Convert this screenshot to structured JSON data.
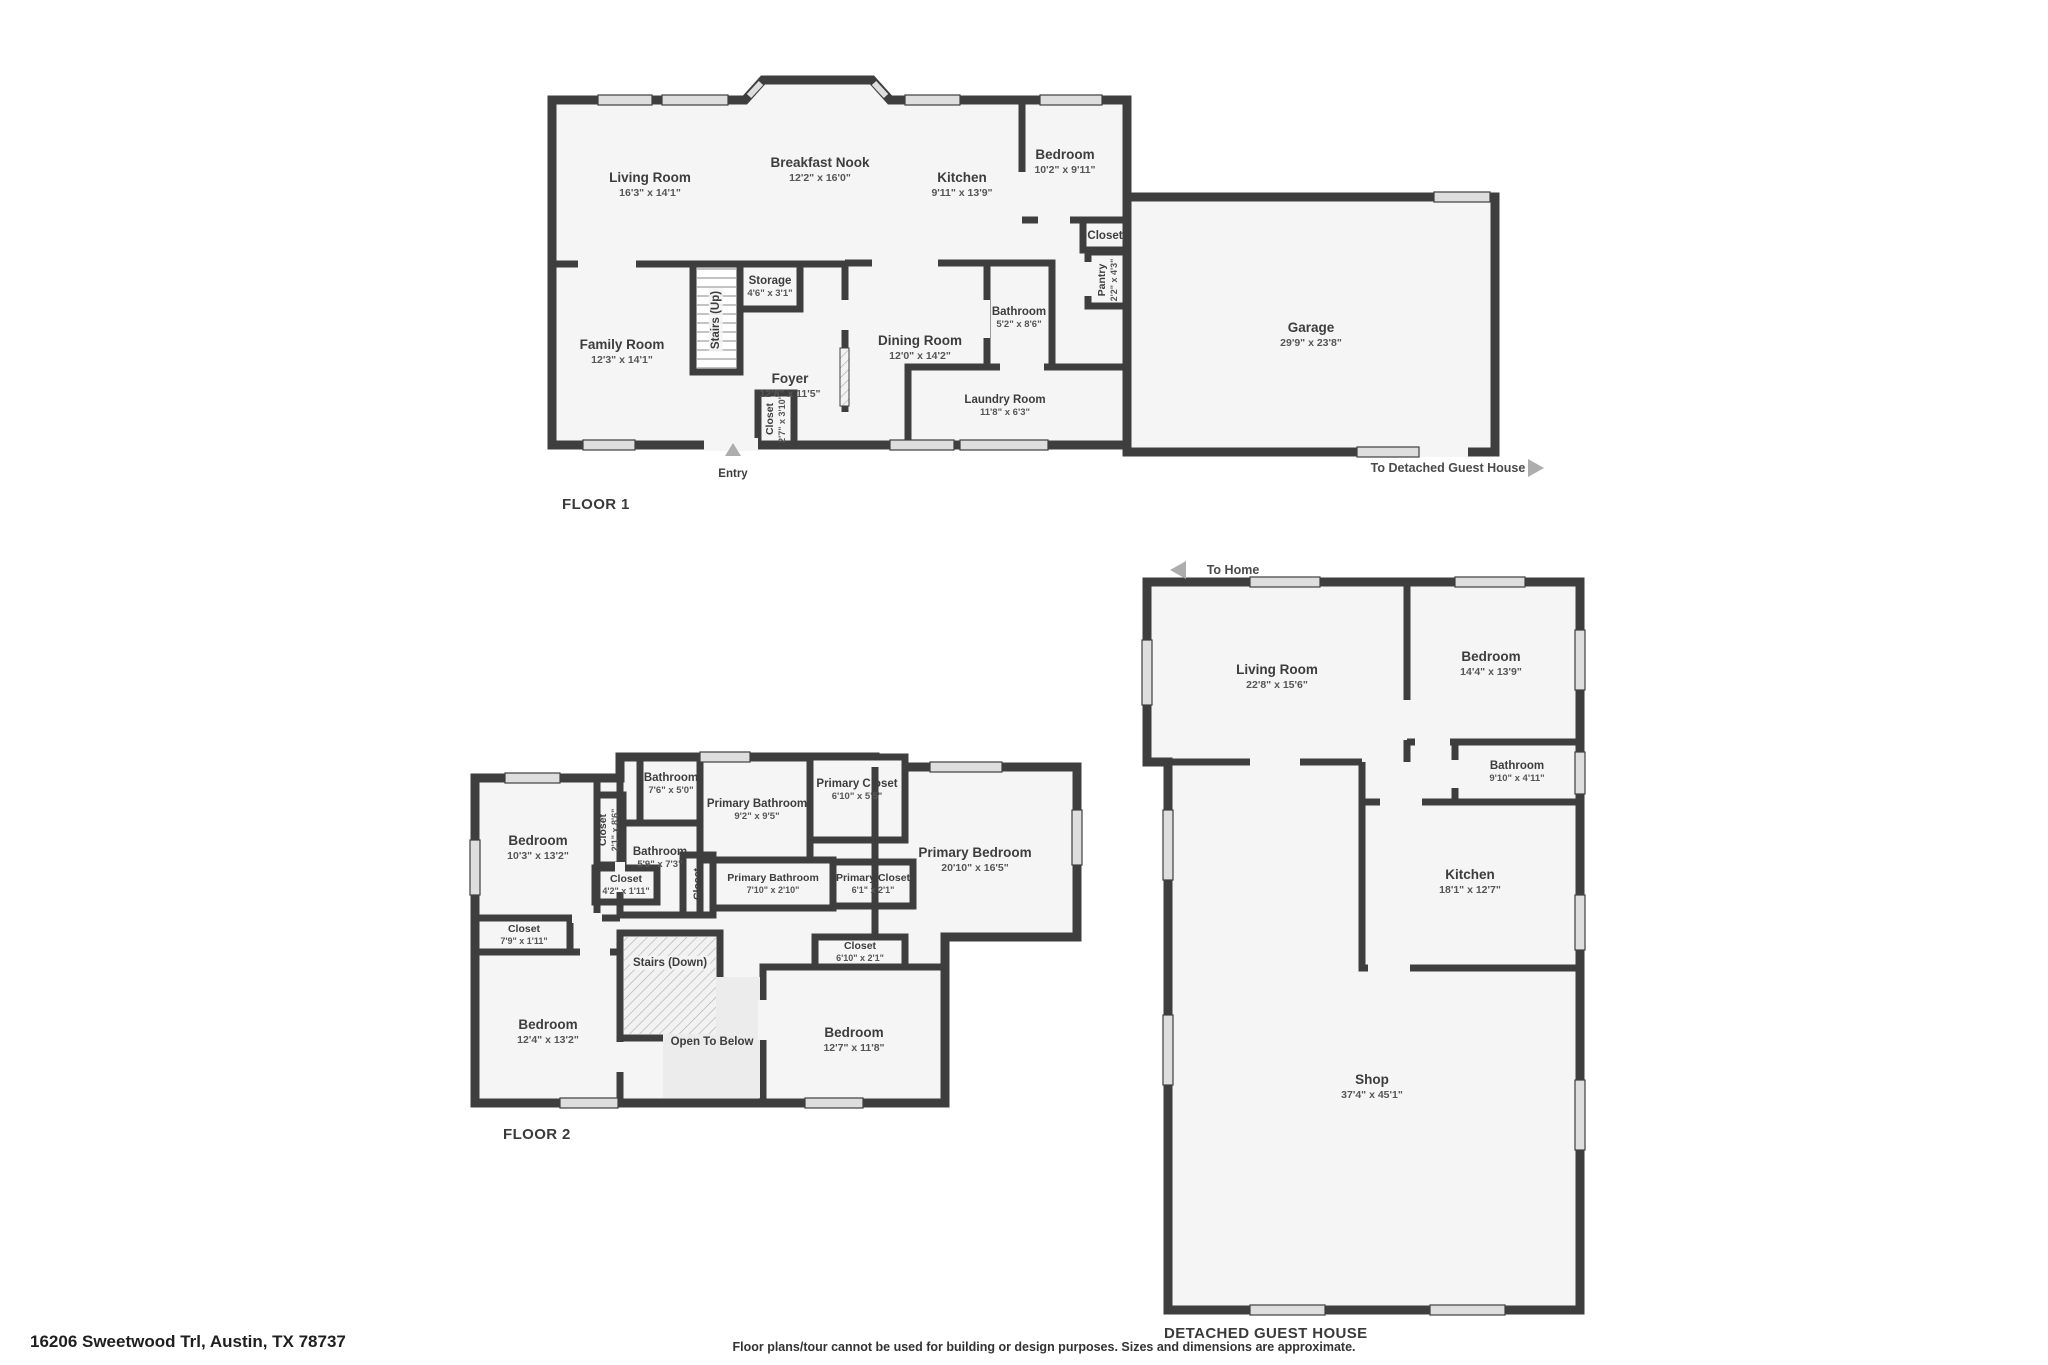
{
  "footer": {
    "address": "16206 Sweetwood Trl, Austin, TX 78737",
    "disclaimer": "Floor plans/tour cannot be used for building or design purposes. Sizes and dimensions are approximate."
  },
  "colors": {
    "wall": "#3e3e3e",
    "floor_fill": "#f5f5f5",
    "open_below_fill": "#ececec",
    "window_fill": "#dedede",
    "arrow_gray": "#adadad"
  },
  "floor1": {
    "title": "FLOOR 1",
    "entry_label": "Entry",
    "to_guest_label": "To Detached Guest House",
    "rooms": [
      {
        "name": "Living Room",
        "dims": "16'3\" x 14'1\""
      },
      {
        "name": "Breakfast Nook",
        "dims": "12'2\" x 16'0\""
      },
      {
        "name": "Kitchen",
        "dims": "9'11\" x 13'9\""
      },
      {
        "name": "Bedroom",
        "dims": "10'2\" x 9'11\""
      },
      {
        "name": "Closet",
        "dims": ""
      },
      {
        "name": "Pantry",
        "dims": "2'2\" x 4'3\""
      },
      {
        "name": "Family Room",
        "dims": "12'3\" x 14'1\""
      },
      {
        "name": "Stairs (Up)",
        "dims": ""
      },
      {
        "name": "Storage",
        "dims": "4'6\" x 3'1\""
      },
      {
        "name": "Foyer",
        "dims": "12'8\" x 11'5\""
      },
      {
        "name": "Dining Room",
        "dims": "12'0\" x 14'2\""
      },
      {
        "name": "Bathroom",
        "dims": "5'2\" x 8'6\""
      },
      {
        "name": "Laundry Room",
        "dims": "11'8\" x 6'3\""
      },
      {
        "name": "Closet",
        "dims": "2'7\" x 3'10\""
      },
      {
        "name": "Garage",
        "dims": "29'9\" x 23'8\""
      }
    ]
  },
  "floor2": {
    "title": "FLOOR 2",
    "rooms": [
      {
        "name": "Bedroom",
        "dims": "10'3\" x 13'2\""
      },
      {
        "name": "Closet",
        "dims": "2'1\" x 8'6\""
      },
      {
        "name": "Bathroom",
        "dims": "7'6\" x 5'0\""
      },
      {
        "name": "Primary Bathroom",
        "dims": "9'2\" x 9'5\""
      },
      {
        "name": "Primary Closet",
        "dims": "6'10\" x 5'5\""
      },
      {
        "name": "Bathroom",
        "dims": "5'9\" x 7'3\""
      },
      {
        "name": "Closet",
        "dims": "4'2\" x 1'11\""
      },
      {
        "name": "Closet",
        "dims": ""
      },
      {
        "name": "Primary Bathroom",
        "dims": "7'10\" x 2'10\""
      },
      {
        "name": "Primary Closet",
        "dims": "6'1\" x 2'1\""
      },
      {
        "name": "Primary Bedroom",
        "dims": "20'10\" x 16'5\""
      },
      {
        "name": "Closet",
        "dims": "7'9\" x 1'11\""
      },
      {
        "name": "Stairs (Down)",
        "dims": ""
      },
      {
        "name": "Open To Below",
        "dims": ""
      },
      {
        "name": "Bedroom",
        "dims": "12'4\" x 13'2\""
      },
      {
        "name": "Closet",
        "dims": "6'10\" x 2'1\""
      },
      {
        "name": "Bedroom",
        "dims": "12'7\" x 11'8\""
      }
    ]
  },
  "guest_house": {
    "title": "DETACHED GUEST HOUSE",
    "to_home_label": "To Home",
    "rooms": [
      {
        "name": "Living Room",
        "dims": "22'8\" x 15'6\""
      },
      {
        "name": "Bedroom",
        "dims": "14'4\" x 13'9\""
      },
      {
        "name": "Bathroom",
        "dims": "9'10\" x 4'11\""
      },
      {
        "name": "Kitchen",
        "dims": "18'1\" x 12'7\""
      },
      {
        "name": "Shop",
        "dims": "37'4\" x 45'1\""
      }
    ]
  }
}
